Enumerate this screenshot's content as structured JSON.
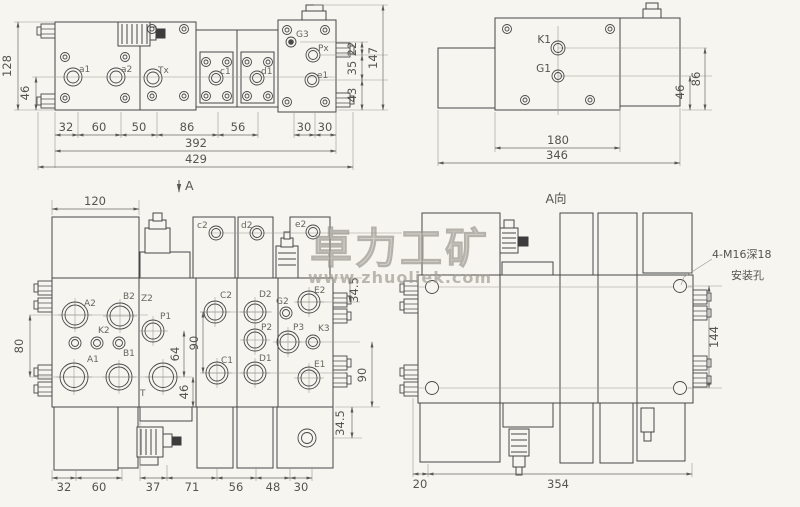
{
  "watermark": {
    "brand": "卓力工矿",
    "url": "www.zhuoliek.com"
  },
  "plan_view": {
    "ports": {
      "a1": "a1",
      "a2": "a2",
      "tx": "Tx",
      "c1": "c1",
      "d1": "d1",
      "g3": "G3",
      "px": "Px",
      "e1": "e1"
    },
    "dims": {
      "height": "128",
      "height_sub": "46",
      "w1": "32",
      "w2": "60",
      "w3": "50",
      "w4": "86",
      "w5": "56",
      "w6": "30",
      "w7": "30",
      "width_sub": "392",
      "width_total": "429",
      "r1": "22",
      "r2": "35",
      "r3": "43",
      "r_total": "147"
    }
  },
  "side_view": {
    "ports": {
      "k1": "K1",
      "g1": "G1"
    },
    "dims": {
      "width_block": "180",
      "width_total": "346",
      "h1": "46",
      "h2": "86"
    }
  },
  "front_view": {
    "section_arrow": "A",
    "ports": {
      "a2": "A2",
      "b2": "B2",
      "z2": "Z2",
      "k2": "K2",
      "a1": "A1",
      "b1": "B1",
      "p1": "P1",
      "t": "T",
      "c2_small": "c2",
      "d2_small": "d2",
      "e2_small": "e2",
      "c2": "C2",
      "c1": "C1",
      "d2": "D2",
      "p2": "P2",
      "d1": "D1",
      "g2": "G2",
      "e2": "E2",
      "p3": "P3",
      "k3": "K3",
      "e1": "E1"
    },
    "dims": {
      "top": "120",
      "left": "80",
      "v64": "64",
      "v46": "46",
      "v90": "90",
      "r1": "34.5",
      "r2": "90",
      "r3": "34.5",
      "w1": "32",
      "w2": "60",
      "w3": "37",
      "w4": "71",
      "w5": "56",
      "w6": "48",
      "w7": "30"
    }
  },
  "rear_view": {
    "view_label": "A向",
    "note_line1": "4-M16深18",
    "note_line2": "安装孔",
    "dims": {
      "w1": "20",
      "w2": "354",
      "h1": "144"
    }
  }
}
